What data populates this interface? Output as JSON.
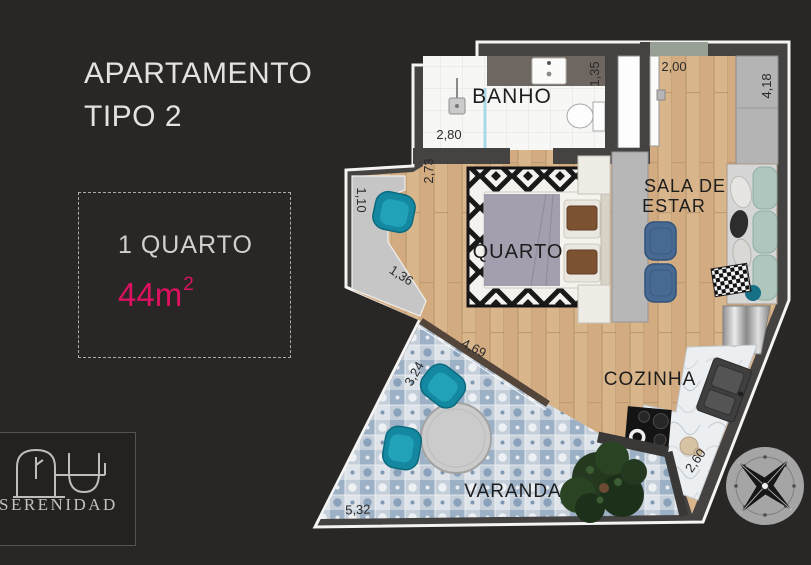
{
  "header": {
    "title_line1": "APARTAMENTO",
    "title_line2": "TIPO 2"
  },
  "info_box": {
    "bedrooms": "1 QUARTO",
    "area_value": "44m",
    "area_sup": "2"
  },
  "brand": {
    "name": "SERENIDAD",
    "logo_icon": "arch-and-bowl-monogram"
  },
  "floor_plan": {
    "rooms": {
      "banho": "BANHO",
      "quarto": "QUARTO",
      "sala_line1": "SALA DE",
      "sala_line2": "ESTAR",
      "cozinha": "COZINHA",
      "varanda": "VARANDA"
    },
    "dimensions": {
      "banho_width": "2,80",
      "banho_depth": "1,35",
      "entry_width": "2,00",
      "sala_depth": "4,18",
      "quarto_depth": "2,73",
      "nook_depth": "1,10",
      "nook_diag": "1,36",
      "varanda_top": "4,69",
      "varanda_left": "3,24",
      "varanda_bottom": "5,32",
      "cozinha_diag": "2,60"
    },
    "compass_icon": "compass-rose"
  },
  "colors": {
    "background": "#292626",
    "wall": "#454242",
    "accent_pink": "#dc1160",
    "wood": "#d9b58c",
    "balcony_tile": "#c5cfda",
    "teal_furniture": "#1488a0",
    "navy_chairs": "#486a92"
  }
}
